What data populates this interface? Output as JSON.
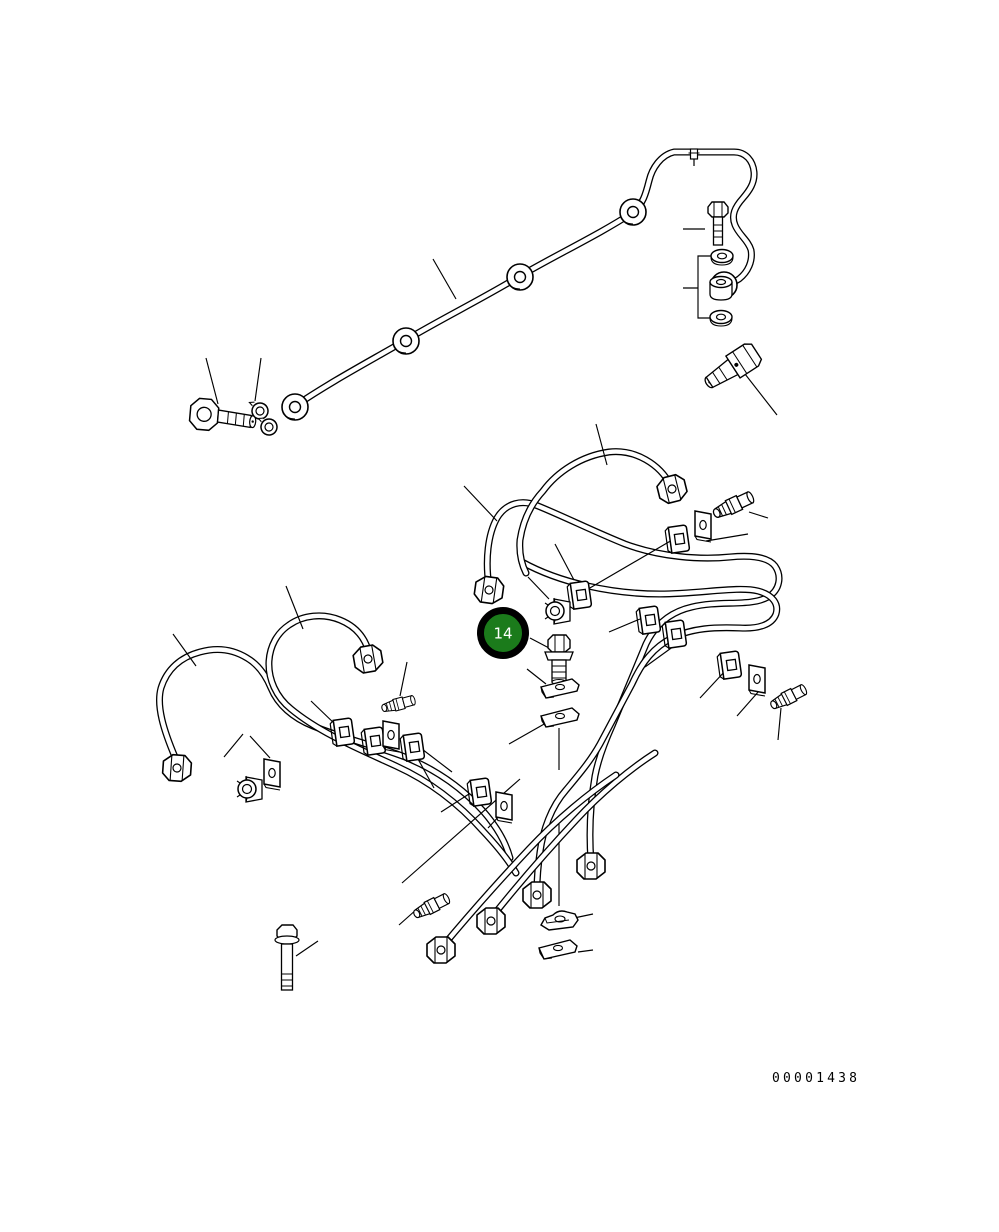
{
  "document": {
    "type": "engine-fuel-piping-parts-diagram",
    "drawing_number": "00001438"
  },
  "callout": {
    "number": "14",
    "fill_color": "#1b7b1b",
    "ring_color": "#000000",
    "text_color": "#ffffff"
  },
  "canvas": {
    "background_color": "#ffffff",
    "line_color": "#000000"
  },
  "parts": {
    "icons": [
      "leak-off-pipe",
      "banjo-bolt",
      "joint-rings",
      "eye-ring",
      "hex-bolt",
      "flat-washer",
      "spacer-collar",
      "connector-bolt",
      "fuel-injection-pipe",
      "sleeve-nut",
      "pipe-clip",
      "clamp-plate",
      "nut-clamp",
      "wing-plate",
      "saddle-clamp",
      "flange-bolt"
    ]
  }
}
